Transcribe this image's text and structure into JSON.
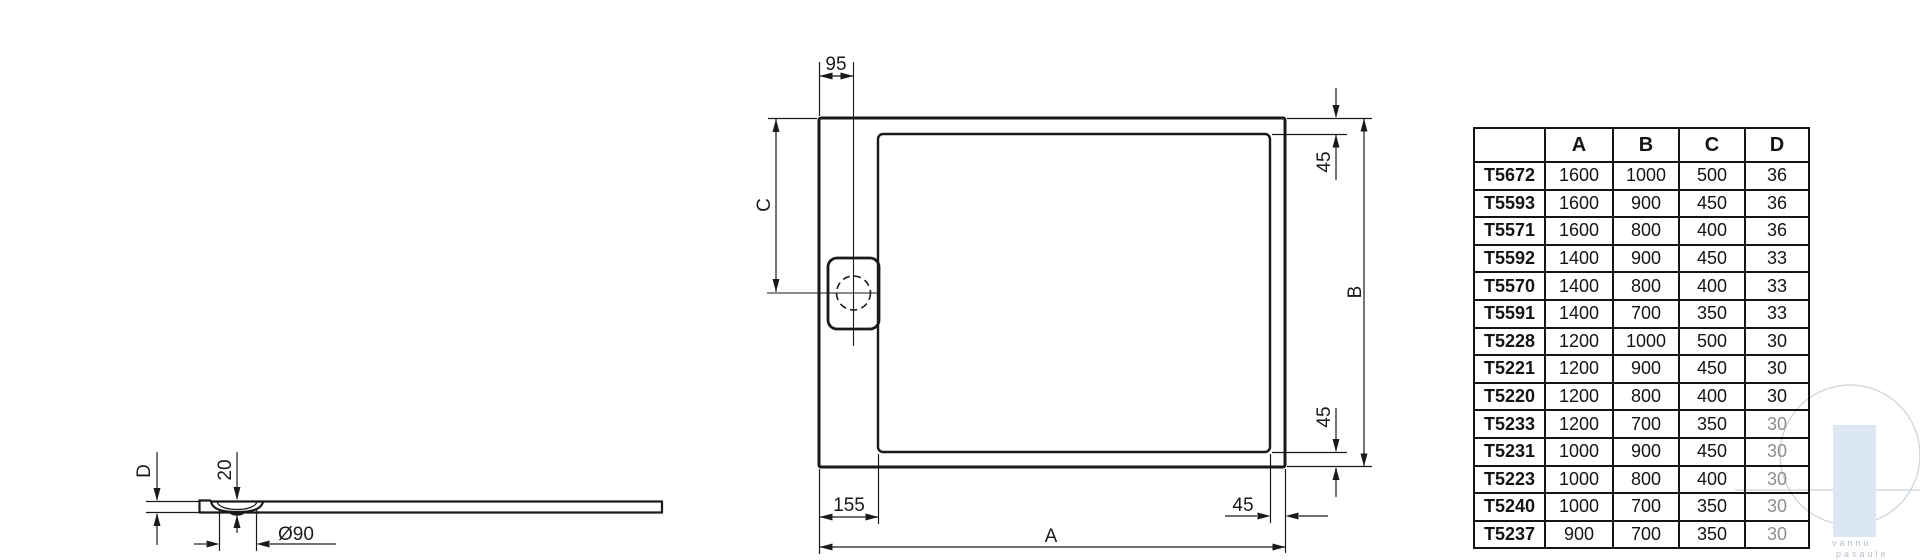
{
  "drawing": {
    "line_color": "#1a1a1a",
    "labels": {
      "a": "A",
      "b": "B",
      "c": "C",
      "d": "D",
      "w95": "95",
      "w45": "45",
      "w155": "155",
      "w20": "20",
      "dia": "Ø90"
    }
  },
  "table": {
    "headers": [
      "",
      "A",
      "B",
      "C",
      "D"
    ],
    "rows": [
      {
        "model": "T5672",
        "a": "1600",
        "b": "1000",
        "c": "500",
        "d": "36"
      },
      {
        "model": "T5593",
        "a": "1600",
        "b": "900",
        "c": "450",
        "d": "36"
      },
      {
        "model": "T5571",
        "a": "1600",
        "b": "800",
        "c": "400",
        "d": "36"
      },
      {
        "model": "T5592",
        "a": "1400",
        "b": "900",
        "c": "450",
        "d": "33"
      },
      {
        "model": "T5570",
        "a": "1400",
        "b": "800",
        "c": "400",
        "d": "33"
      },
      {
        "model": "T5591",
        "a": "1400",
        "b": "700",
        "c": "350",
        "d": "33"
      },
      {
        "model": "T5228",
        "a": "1200",
        "b": "1000",
        "c": "500",
        "d": "30"
      },
      {
        "model": "T5221",
        "a": "1200",
        "b": "900",
        "c": "450",
        "d": "30"
      },
      {
        "model": "T5220",
        "a": "1200",
        "b": "800",
        "c": "400",
        "d": "30"
      },
      {
        "model": "T5233",
        "a": "1200",
        "b": "700",
        "c": "350",
        "d": "30"
      },
      {
        "model": "T5231",
        "a": "1000",
        "b": "900",
        "c": "450",
        "d": "30"
      },
      {
        "model": "T5223",
        "a": "1000",
        "b": "800",
        "c": "400",
        "d": "30"
      },
      {
        "model": "T5240",
        "a": "1000",
        "b": "700",
        "c": "350",
        "d": "30"
      },
      {
        "model": "T5237",
        "a": "900",
        "b": "700",
        "c": "350",
        "d": "30"
      }
    ]
  },
  "watermark": {
    "line1": "vannu",
    "line2": "pasaule",
    "accent_color": "#dbe7f2"
  }
}
